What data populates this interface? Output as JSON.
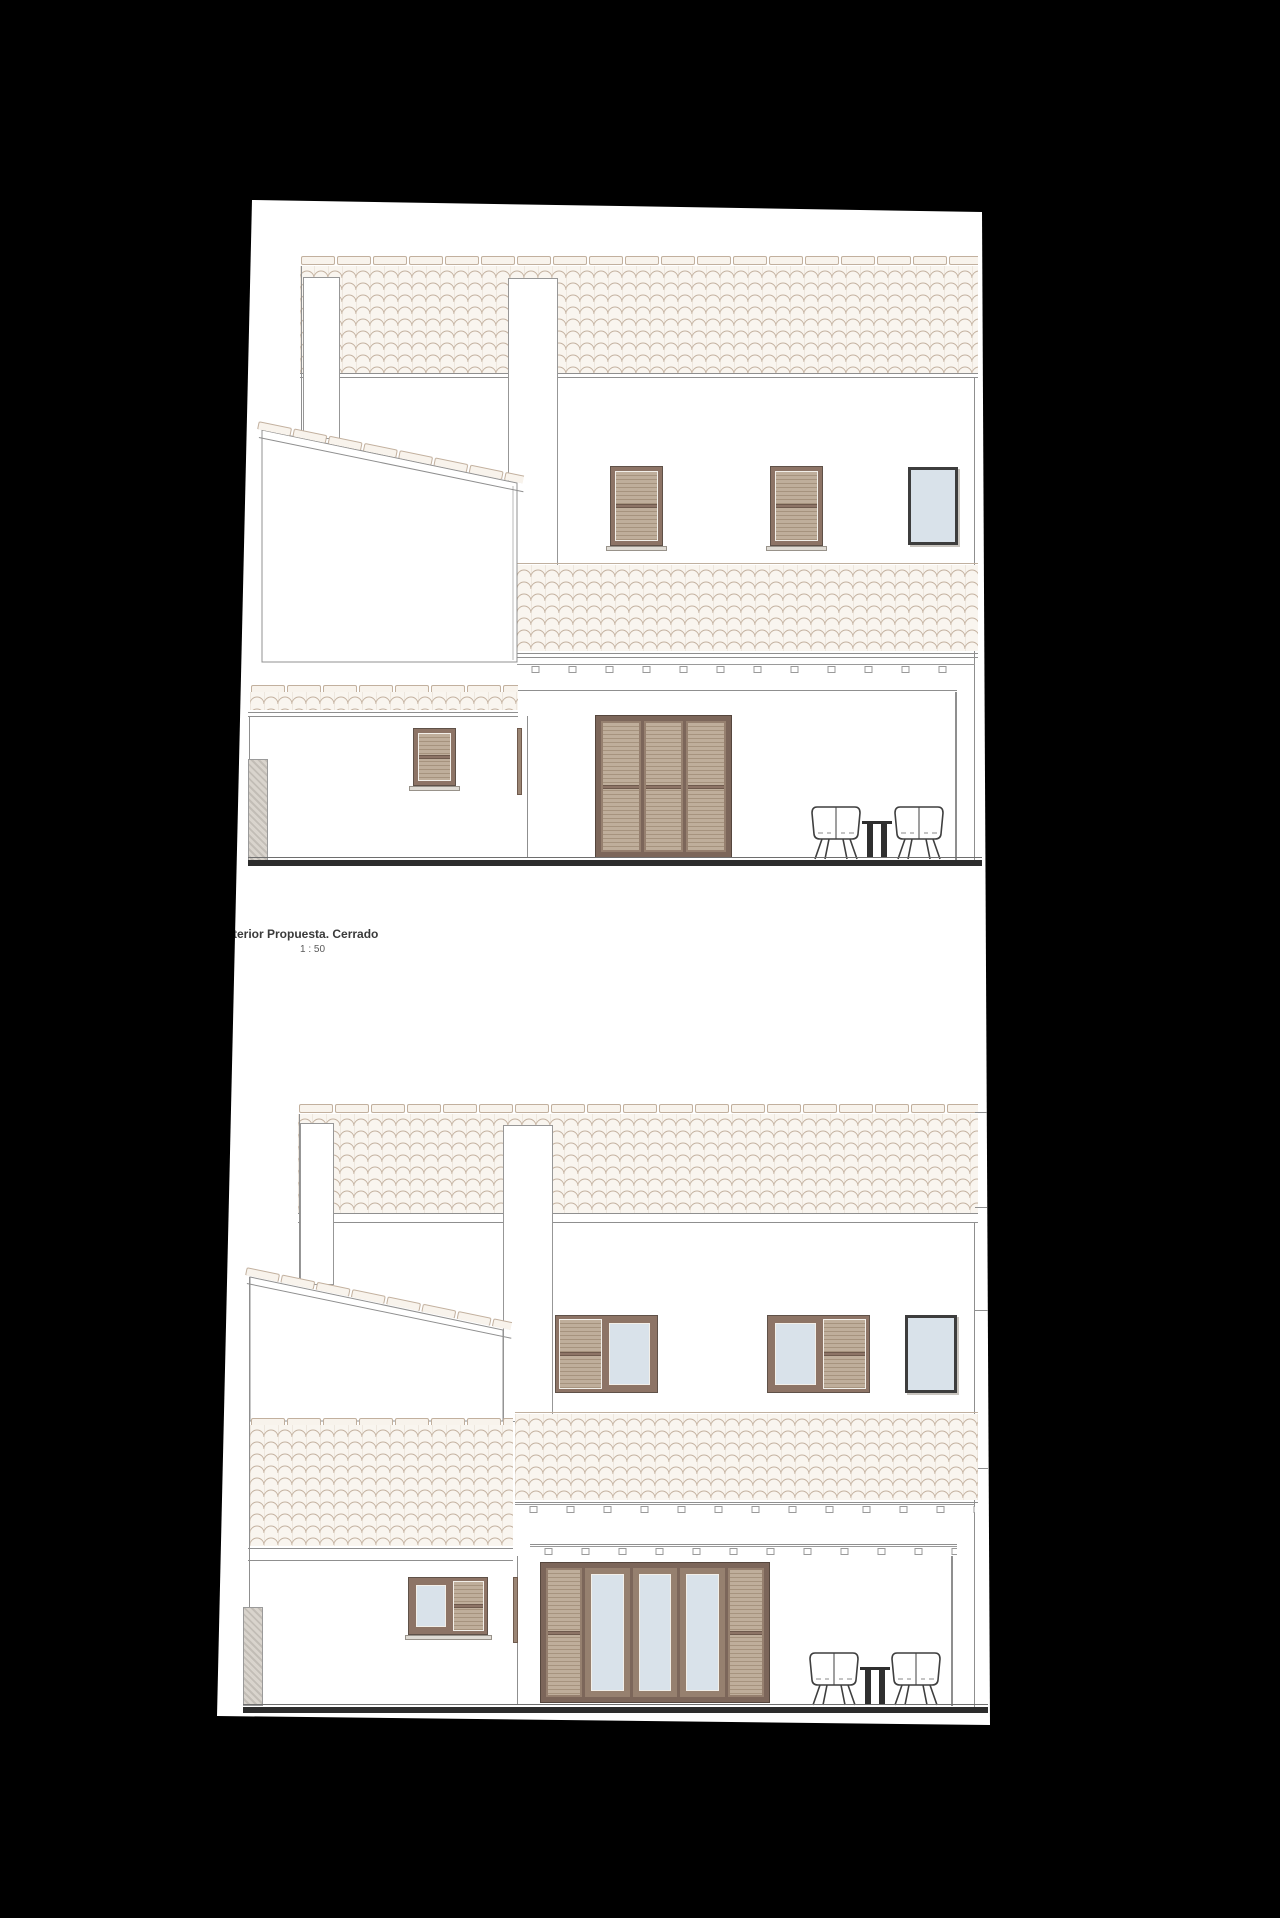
{
  "annotation": {
    "title": "terior Propuesta. Cerrado",
    "scale": "1 : 50"
  },
  "sheet": {
    "background": "#ffffff",
    "surround": "#000000"
  },
  "palette": {
    "line": "#8f8f8f",
    "tile_stroke": "#c4b2a0",
    "tile_fill": "#f9f5ef",
    "ridge_fill": "#f8f3ec",
    "shutter_frame": "#8d7466",
    "shutter_frame_dark": "#5f5148",
    "louver_light": "#bfae9b",
    "louver_dark": "#a6937e",
    "door_frame": "#7c665a",
    "glass": "#d9e2ea",
    "glass_frame": "#3d3d3d",
    "sill": "#dfdbd4",
    "ground": "#2c2c2c",
    "pillar_hatch": "#d9d4cd"
  },
  "elevations": {
    "upper": {
      "name": "rear-elevation-shutters-closed",
      "windows": [
        "louvered-shutter-window",
        "louvered-shutter-window",
        "glazed-window"
      ],
      "door": "three-leaf-louvered-shutter-door",
      "furniture": [
        "tub-chair",
        "side-table",
        "tub-chair"
      ]
    },
    "lower": {
      "name": "rear-elevation-shutters-open",
      "windows": [
        "shutter-and-glass-window",
        "glass-and-shutter-window",
        "glazed-window"
      ],
      "door": "five-leaf-door-three-glazed-two-louvered",
      "furniture": [
        "tub-chair",
        "side-table",
        "tub-chair"
      ]
    }
  }
}
